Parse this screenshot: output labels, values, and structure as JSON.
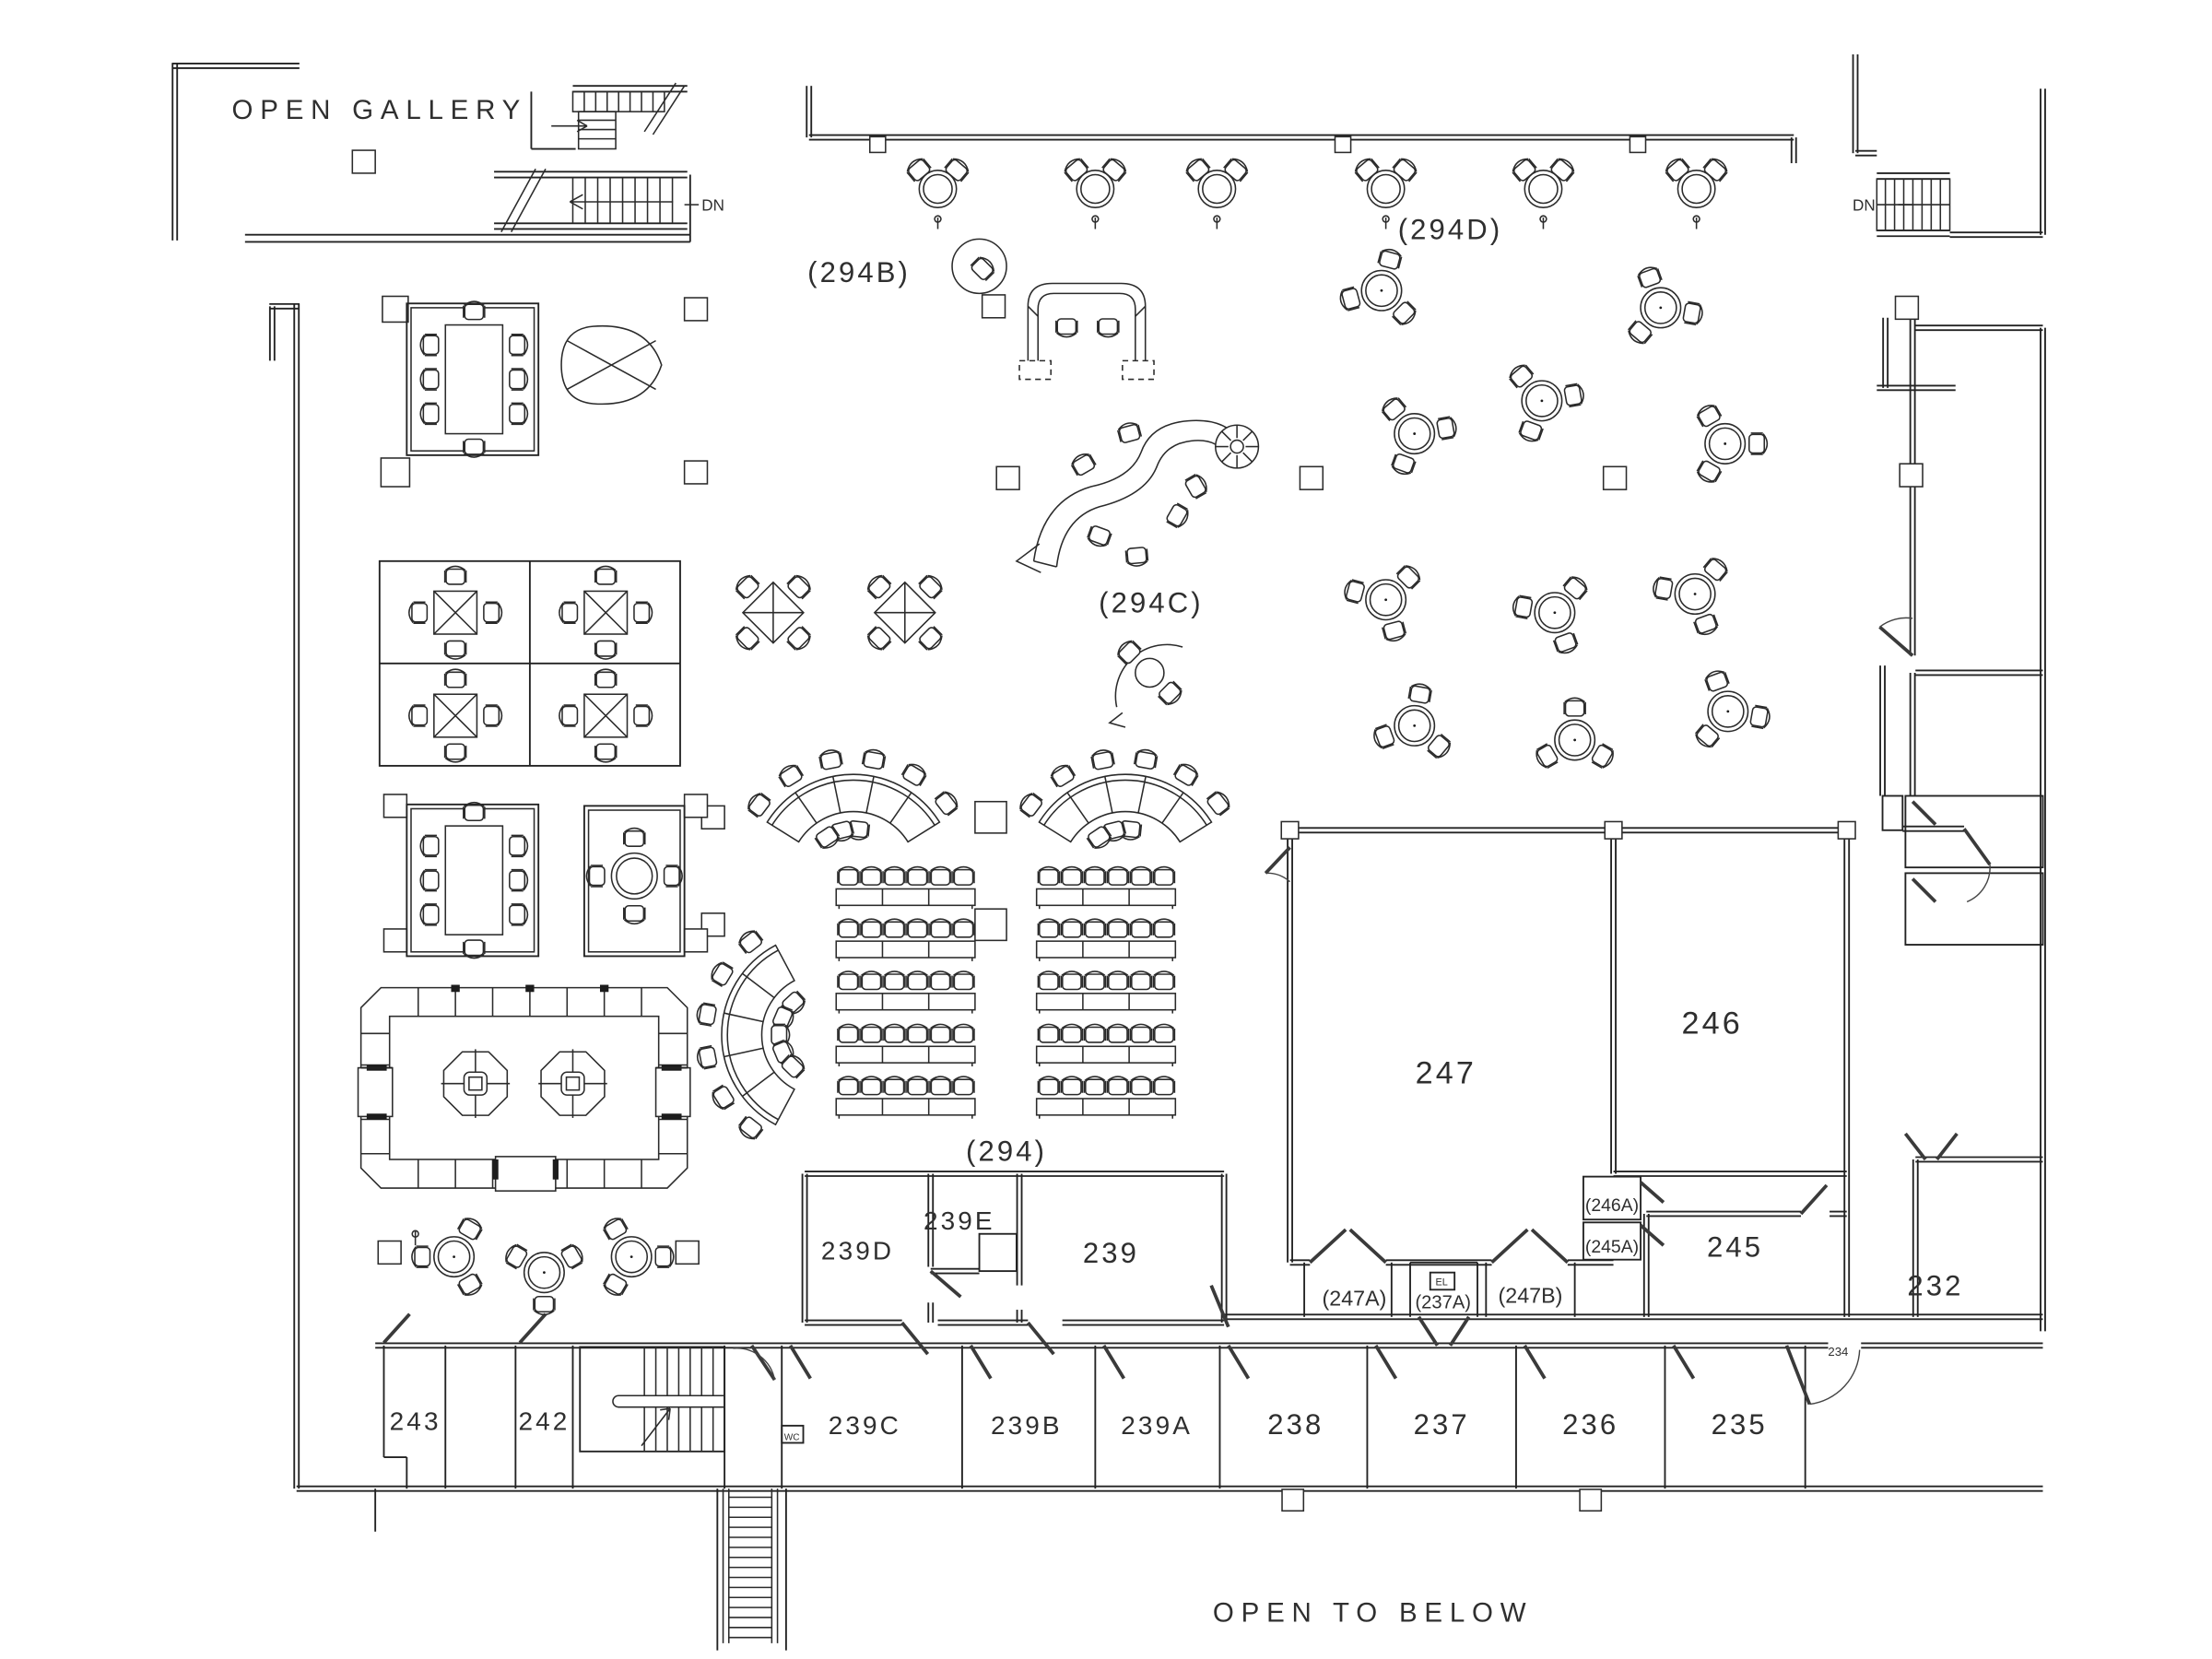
{
  "sheet": {
    "background": "#ffffff",
    "ink": "#2b2b2b"
  },
  "areas": {
    "open_gallery": "OPEN GALLERY",
    "hall_294": "(294)",
    "reception_294b": "(294B)",
    "training_294c": "(294C)",
    "collab_294d": "(294D)",
    "open_to_below": "OPEN TO BELOW"
  },
  "stairs": {
    "down_left": "DN",
    "down_right": "DN"
  },
  "rooms": {
    "r247": "247",
    "r246": "246",
    "r245": "245",
    "r246a": "(246A)",
    "r245a": "(245A)",
    "r247a": "(247A)",
    "r237a": "(237A)",
    "r247b": "(247B)",
    "r243": "243",
    "r242": "242",
    "r239": "239",
    "r239a": "239A",
    "r239b": "239B",
    "r239c": "239C",
    "r239d": "239D",
    "r239e": "239E",
    "r238": "238",
    "r237": "237",
    "r236": "236",
    "r235": "235",
    "r234": "234",
    "r232": "232",
    "wc": "WC",
    "el": "EL"
  }
}
